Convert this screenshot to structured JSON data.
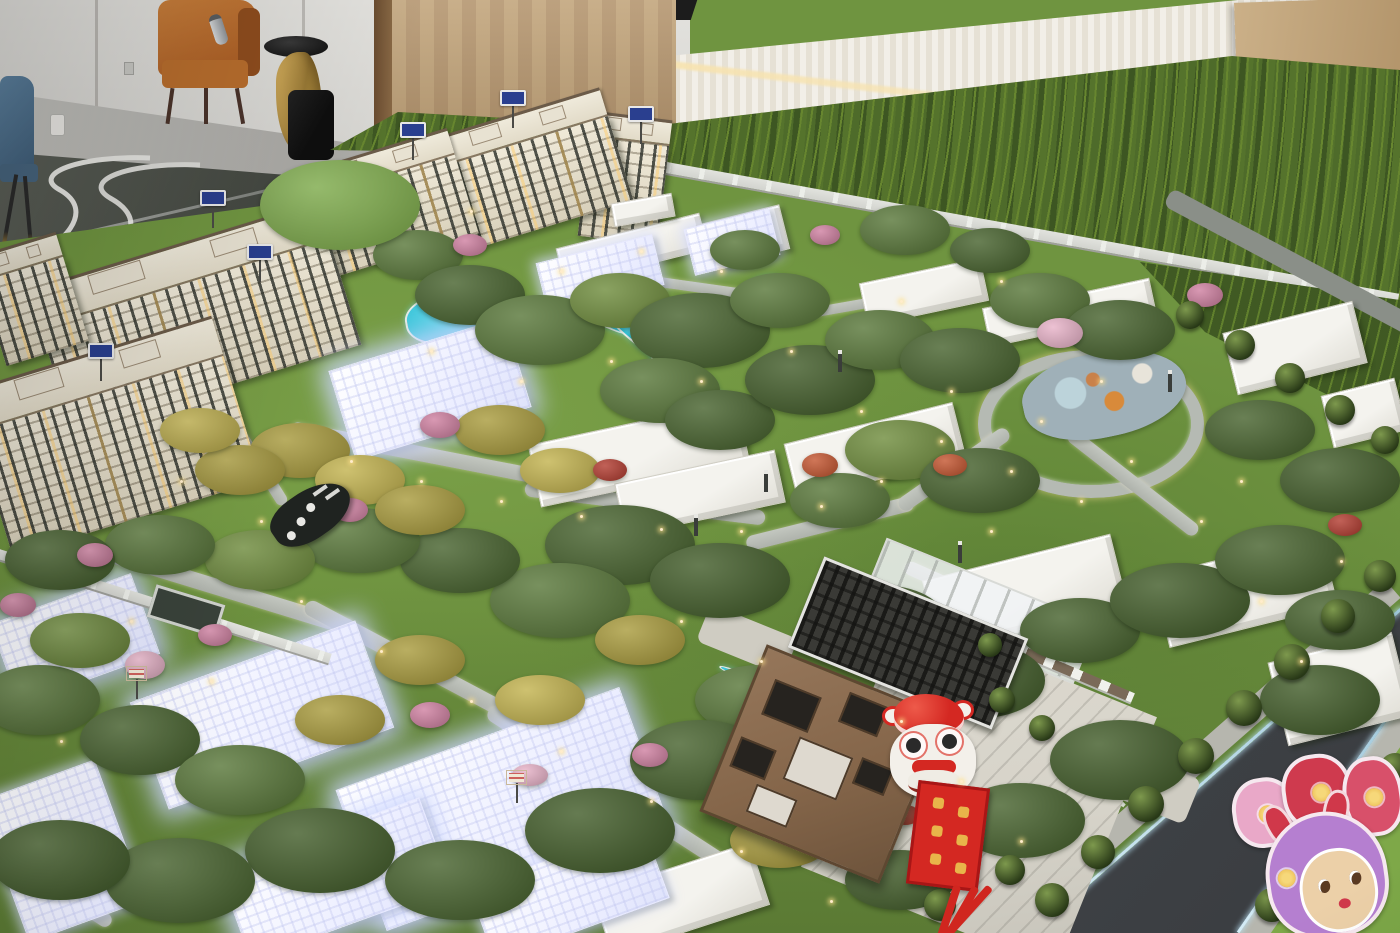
{
  "meta": {
    "scene": "Photograph of an illuminated architectural scale model of a residential community displayed in a sales showroom",
    "view": "high-angle oblique"
  },
  "palette": {
    "lawn": "#6f9440",
    "forest_dark": "#3d5622",
    "forest_mid": "#4e6b2a",
    "forest_light": "#67862f",
    "road_light": "#b9bdb7",
    "road_dark": "#43464a",
    "water": "#35c3d8",
    "apartment_facade": "#e9e3d2",
    "apartment_trim": "#6b5b49",
    "villa_white": "#f2f1ea",
    "villa_glow": "#e9ebff",
    "canopy_brown": "#85664a",
    "lion_red": "#d42822",
    "banner_gold": "#e8b54a",
    "plaque_blue": "#2a3f8f",
    "slat_wall": "#efece4",
    "wood_panel": "#b3946a",
    "leather_chair": "#b5672a",
    "gold_table": "#c9a54a",
    "marble_floor": "#b9b8b4",
    "plaza": "#d6d3c9",
    "glow_curb": "#9fc7da",
    "rabbit_pink": "#e9a8c8",
    "rabbit_purple": "#b57fd0",
    "rabbit_red": "#d0384a",
    "rabbit_face": "#ecd0a8"
  },
  "showroom": {
    "furniture": [
      "leather-armchair",
      "metal-bottle",
      "gold-side-table",
      "black-bowl",
      "waste-bag",
      "blue-chair",
      "floor-dispenser"
    ],
    "surfaces": [
      "white-wall",
      "wood-panel-wall",
      "marble-floor",
      "slat-display-wall",
      "wood-board",
      "floor-road-graphic"
    ]
  },
  "model": {
    "areas": [
      "backdrop-forest",
      "perimeter-fence",
      "apartment-cluster",
      "white-villa-clusters",
      "illuminated-glowing-villas",
      "illuminated-clubhouse",
      "swimming-pool",
      "stream",
      "pond",
      "playground",
      "loop-road",
      "internal-roads",
      "entrance-canopy",
      "entrance-pergola",
      "entrance-plaza",
      "city-road",
      "street-trees",
      "flowering-shrubs",
      "path-lamps"
    ],
    "decorations": [
      "lion-dance-head",
      "red-banner",
      "red-tassels",
      "rabbit-new-year-cutouts"
    ],
    "signs": {
      "building_plaques": {
        "count": 6,
        "color": "#2a3f8f",
        "text": ""
      },
      "small_white_signs": {
        "count": 2,
        "text": ""
      },
      "feature_wall": {
        "dots": 3,
        "color": "#1f2320"
      }
    }
  }
}
